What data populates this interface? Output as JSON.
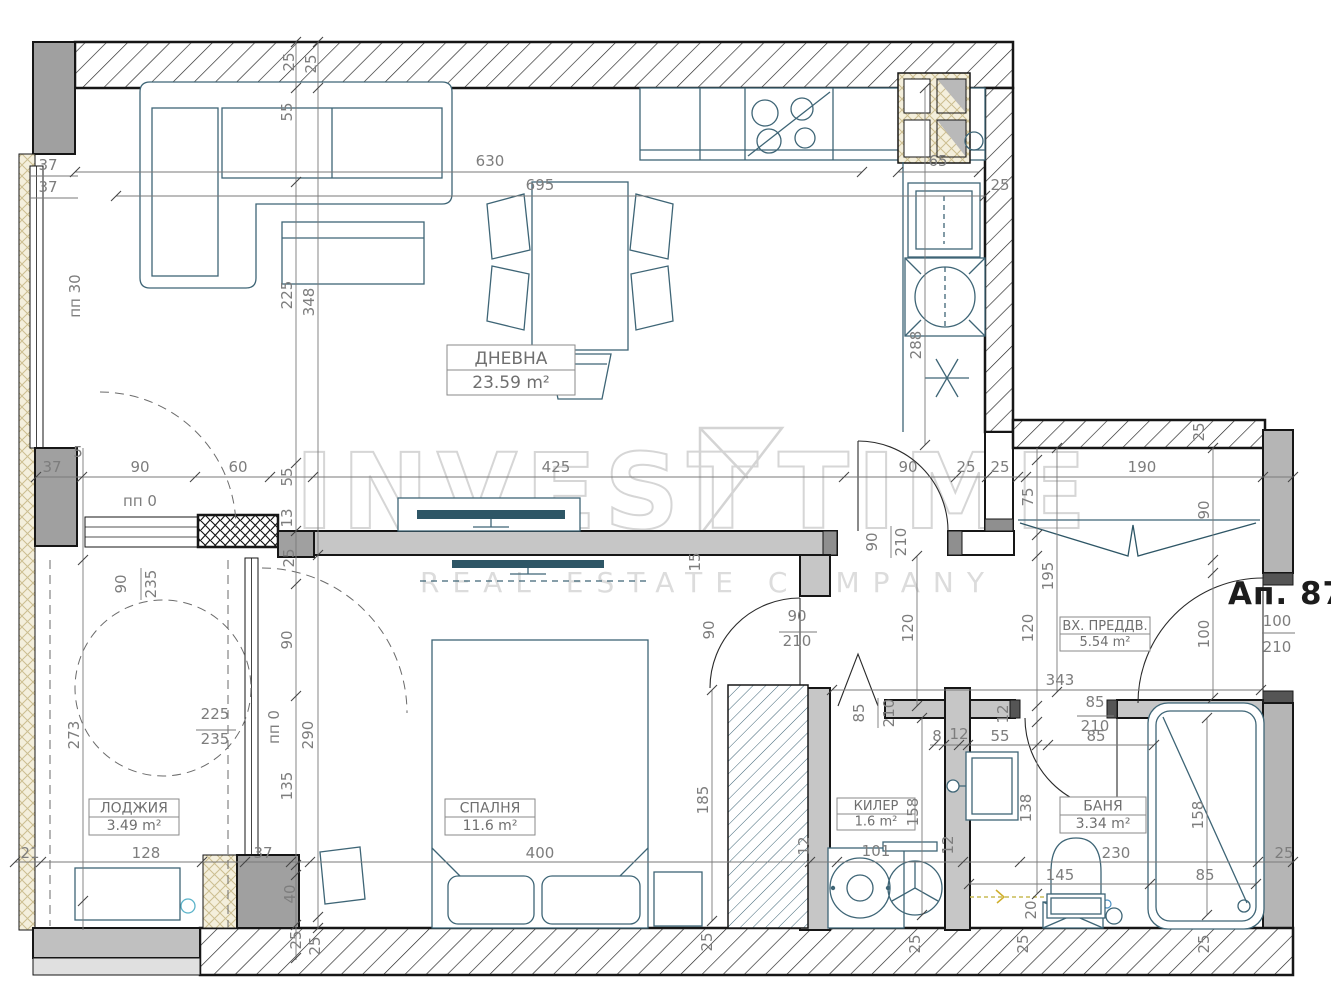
{
  "apartment_label": "Ап. 87",
  "watermark": {
    "part1": "INVEST",
    "part2": "TIME",
    "line2": "REAL ESTATE COMPANY"
  },
  "rooms": [
    {
      "name": "ДНЕВНА",
      "area": "23.59 m²",
      "cx": 511,
      "cy": 370,
      "w": 128,
      "h": 50,
      "fs": 17
    },
    {
      "name": "СПАЛНЯ",
      "area": "11.6 m²",
      "cx": 490,
      "cy": 817,
      "w": 90,
      "h": 36,
      "fs": 14
    },
    {
      "name": "ЛОДЖИЯ",
      "area": "3.49 m²",
      "cx": 134,
      "cy": 817,
      "w": 90,
      "h": 36,
      "fs": 14
    },
    {
      "name": "КИЛЕР",
      "area": "1.6 m²",
      "cx": 876,
      "cy": 814,
      "w": 78,
      "h": 32,
      "fs": 13
    },
    {
      "name": "БАНЯ",
      "area": "3.34 m²",
      "cx": 1103,
      "cy": 815,
      "w": 86,
      "h": 36,
      "fs": 14
    },
    {
      "name": "ВХ. ПРЕДДВ.",
      "area": "5.54 m²",
      "cx": 1105,
      "cy": 634,
      "w": 90,
      "h": 34,
      "fs": 13
    }
  ],
  "dimensions": [
    {
      "t": "630",
      "x": 490,
      "y": 166,
      "r": 0
    },
    {
      "t": "695",
      "x": 540,
      "y": 190,
      "r": 0
    },
    {
      "t": "65",
      "x": 938,
      "y": 166,
      "r": 0
    },
    {
      "t": "25",
      "x": 1000,
      "y": 190,
      "r": 0
    },
    {
      "t": "25",
      "x": 294,
      "y": 62,
      "r": -90
    },
    {
      "t": "25",
      "x": 316,
      "y": 64,
      "r": -90
    },
    {
      "t": "55",
      "x": 292,
      "y": 112,
      "r": -90
    },
    {
      "t": "225",
      "x": 292,
      "y": 295,
      "r": -90
    },
    {
      "t": "348",
      "x": 314,
      "y": 302,
      "r": -90
    },
    {
      "t": "37",
      "x": 48,
      "y": 170,
      "r": 0
    },
    {
      "t": "37",
      "x": 48,
      "y": 192,
      "r": 0
    },
    {
      "t": "пп 30",
      "x": 80,
      "y": 296,
      "r": -90
    },
    {
      "t": "288",
      "x": 921,
      "y": 345,
      "r": -90
    },
    {
      "t": "5",
      "x": 78,
      "y": 457,
      "r": 0
    },
    {
      "t": "37",
      "x": 52,
      "y": 472,
      "r": 0
    },
    {
      "t": "90",
      "x": 140,
      "y": 472,
      "r": 0
    },
    {
      "t": "60",
      "x": 238,
      "y": 472,
      "r": 0
    },
    {
      "t": "55",
      "x": 292,
      "y": 477,
      "r": -90
    },
    {
      "t": "425",
      "x": 556,
      "y": 472,
      "r": 0
    },
    {
      "t": "90",
      "x": 908,
      "y": 472,
      "r": 0
    },
    {
      "t": "25",
      "x": 966,
      "y": 472,
      "r": 0
    },
    {
      "t": "25",
      "x": 1000,
      "y": 472,
      "r": 0
    },
    {
      "t": "190",
      "x": 1142,
      "y": 472,
      "r": 0
    },
    {
      "t": "25",
      "x": 1204,
      "y": 432,
      "r": -90
    },
    {
      "t": "пп 0",
      "x": 140,
      "y": 506,
      "r": 0
    },
    {
      "t": "13",
      "x": 292,
      "y": 518,
      "r": -90
    },
    {
      "t": "25",
      "x": 294,
      "y": 558,
      "r": -90
    },
    {
      "t": "90",
      "x": 877,
      "y": 542,
      "r": -90
    },
    {
      "t": "210",
      "x": 906,
      "y": 542,
      "r": -90
    },
    {
      "t": "75",
      "x": 1033,
      "y": 497,
      "r": -90
    },
    {
      "t": "15",
      "x": 700,
      "y": 562,
      "r": -90
    },
    {
      "t": "90",
      "x": 126,
      "y": 584,
      "r": -90
    },
    {
      "t": "235",
      "x": 156,
      "y": 584,
      "r": -90
    },
    {
      "t": "195",
      "x": 1053,
      "y": 576,
      "r": -90
    },
    {
      "t": "90",
      "x": 1209,
      "y": 510,
      "r": -90
    },
    {
      "t": "100",
      "x": 1209,
      "y": 634,
      "r": -90
    },
    {
      "t": "100",
      "x": 1277,
      "y": 626,
      "r": 0
    },
    {
      "t": "210",
      "x": 1277,
      "y": 652,
      "r": 0
    },
    {
      "t": "90",
      "x": 292,
      "y": 640,
      "r": -90
    },
    {
      "t": "290",
      "x": 313,
      "y": 735,
      "r": -90
    },
    {
      "t": "135",
      "x": 292,
      "y": 786,
      "r": -90
    },
    {
      "t": "273",
      "x": 79,
      "y": 735,
      "r": -90
    },
    {
      "t": "225",
      "x": 215,
      "y": 719,
      "r": 0
    },
    {
      "t": "235",
      "x": 215,
      "y": 744,
      "r": 0
    },
    {
      "t": "пп 0",
      "x": 279,
      "y": 727,
      "r": -90
    },
    {
      "t": "90",
      "x": 797,
      "y": 621,
      "r": 0
    },
    {
      "t": "210",
      "x": 797,
      "y": 646,
      "r": 0
    },
    {
      "t": "90",
      "x": 714,
      "y": 630,
      "r": -90
    },
    {
      "t": "120",
      "x": 913,
      "y": 628,
      "r": -90
    },
    {
      "t": "120",
      "x": 1033,
      "y": 628,
      "r": -90
    },
    {
      "t": "343",
      "x": 1060,
      "y": 685,
      "r": 0
    },
    {
      "t": "85",
      "x": 864,
      "y": 713,
      "r": -90
    },
    {
      "t": "210",
      "x": 894,
      "y": 713,
      "r": -90
    },
    {
      "t": "85",
      "x": 1095,
      "y": 707,
      "r": 0
    },
    {
      "t": "210",
      "x": 1095,
      "y": 731,
      "r": 0
    },
    {
      "t": "12",
      "x": 1008,
      "y": 714,
      "r": -90
    },
    {
      "t": "8",
      "x": 937,
      "y": 741,
      "r": 0
    },
    {
      "t": "12",
      "x": 959,
      "y": 739,
      "r": 0
    },
    {
      "t": "55",
      "x": 1000,
      "y": 741,
      "r": 0
    },
    {
      "t": "85",
      "x": 1096,
      "y": 741,
      "r": 0
    },
    {
      "t": "185",
      "x": 708,
      "y": 800,
      "r": -90
    },
    {
      "t": "158",
      "x": 918,
      "y": 812,
      "r": -90
    },
    {
      "t": "138",
      "x": 1031,
      "y": 808,
      "r": -90
    },
    {
      "t": "158",
      "x": 1203,
      "y": 815,
      "r": -90
    },
    {
      "t": "12",
      "x": 809,
      "y": 846,
      "r": -90
    },
    {
      "t": "12",
      "x": 953,
      "y": 845,
      "r": -90
    },
    {
      "t": "21",
      "x": 30,
      "y": 858,
      "r": 0
    },
    {
      "t": "128",
      "x": 146,
      "y": 858,
      "r": 0
    },
    {
      "t": "37",
      "x": 263,
      "y": 858,
      "r": 0
    },
    {
      "t": "400",
      "x": 540,
      "y": 858,
      "r": 0
    },
    {
      "t": "101",
      "x": 876,
      "y": 856,
      "r": 0
    },
    {
      "t": "230",
      "x": 1116,
      "y": 858,
      "r": 0
    },
    {
      "t": "25",
      "x": 1284,
      "y": 858,
      "r": 0
    },
    {
      "t": "145",
      "x": 1060,
      "y": 880,
      "r": 0
    },
    {
      "t": "85",
      "x": 1205,
      "y": 880,
      "r": 0
    },
    {
      "t": "40",
      "x": 295,
      "y": 894,
      "r": -90
    },
    {
      "t": "20",
      "x": 1036,
      "y": 910,
      "r": -90
    },
    {
      "t": "25",
      "x": 301,
      "y": 940,
      "r": -90
    },
    {
      "t": "25",
      "x": 320,
      "y": 946,
      "r": -90
    },
    {
      "t": "25",
      "x": 712,
      "y": 942,
      "r": -90
    },
    {
      "t": "25",
      "x": 920,
      "y": 944,
      "r": -90
    },
    {
      "t": "25",
      "x": 1028,
      "y": 944,
      "r": -90
    },
    {
      "t": "25",
      "x": 1209,
      "y": 944,
      "r": -90
    }
  ]
}
